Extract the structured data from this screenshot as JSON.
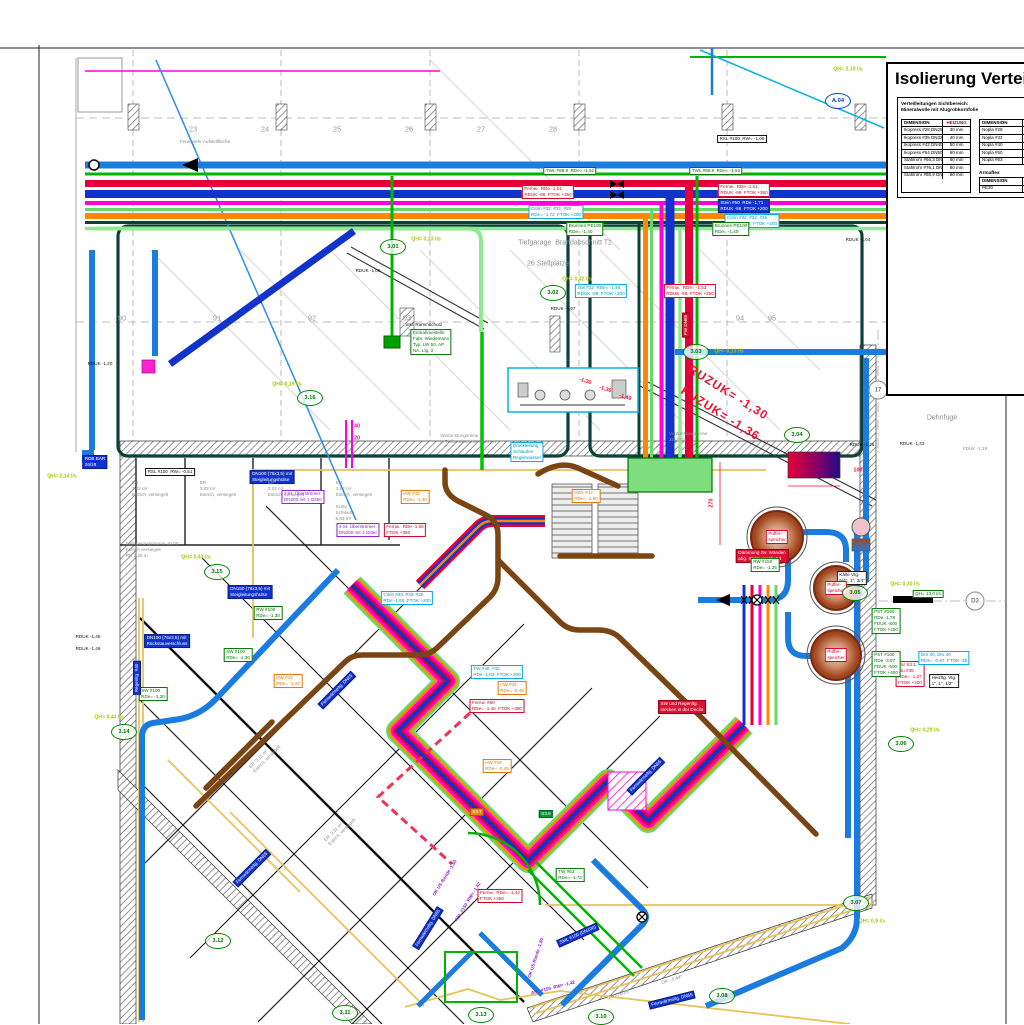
{
  "title_block": {
    "title": "Isolierung Verteilung",
    "note1": "Verteilleitungen Sichtbereich:",
    "note2": "Mineralwolle mit Alugrobkornfolie",
    "armaflex_label": "Armaflex",
    "table1": {
      "headers": [
        "DIMENSION",
        "HEIZUNG"
      ],
      "rows": [
        [
          "Ikopress #28  DN25",
          "30 mm"
        ],
        [
          "Ikopress #35  DN32",
          "40 mm"
        ],
        [
          "Ikopress #42  DN40",
          "50 mm"
        ],
        [
          "Ikopress #54  DN50",
          "60 mm"
        ],
        [
          "Stahlrohr #66,3  DN50",
          "60 mm"
        ],
        [
          "Stahlrohr #76,1  DN65",
          "80 mm"
        ],
        [
          "Stahlrohr #88,9  DN80",
          "90 mm"
        ]
      ]
    },
    "table2": {
      "headers": [
        "DIMENSION",
        ""
      ],
      "rows": [
        [
          "Nopla #28",
          "DN"
        ],
        [
          "Nopla #32",
          "DN"
        ],
        [
          "Nopla #40",
          "DN"
        ],
        [
          "Nopla #50",
          "DN"
        ],
        [
          "Nopla #63",
          "DN"
        ]
      ]
    },
    "table3": {
      "headers": [
        "DIMENSION",
        ""
      ],
      "rows": [
        [
          "PE30",
          "DN"
        ]
      ]
    }
  },
  "palette": {
    "skyblue": "#1b7ce0",
    "navy": "#1133cc",
    "red": "#e60039",
    "green": "#00b400",
    "lightgreen": "#66d966",
    "palegreen": "#90e890",
    "magenta": "#ff00dd",
    "orange": "#ff8800",
    "teal": "#0d4034",
    "brown": "#7a4513",
    "yellow": "#e6c35c",
    "cyan": "#00b4dc",
    "ref_green": "#008800",
    "qh_lime": "#aac800",
    "dim_red": "#ee1133"
  },
  "red_level_note": [
    "RUZUK= -1,30",
    "FUZUK= -1,36"
  ],
  "grid_cols": {
    "y": 129,
    "items": [
      {
        "t": "23",
        "x": 193
      },
      {
        "t": "24",
        "x": 265
      },
      {
        "t": "25",
        "x": 337
      },
      {
        "t": "26",
        "x": 409
      },
      {
        "t": "27",
        "x": 481
      },
      {
        "t": "28",
        "x": 553
      }
    ]
  },
  "grid_rows": {
    "y": 318,
    "items": [
      {
        "t": "90",
        "x": 122
      },
      {
        "t": "91",
        "x": 217
      },
      {
        "t": "92",
        "x": 312
      },
      {
        "t": "93",
        "x": 407
      },
      {
        "t": "94",
        "x": 740
      },
      {
        "t": "95",
        "x": 772
      }
    ]
  },
  "ref_markers": [
    {
      "id": "3.01",
      "x": 393,
      "y": 247
    },
    {
      "id": "3.02",
      "x": 553,
      "y": 293
    },
    {
      "id": "3.03",
      "x": 696,
      "y": 352
    },
    {
      "id": "3.04",
      "x": 797,
      "y": 435
    },
    {
      "id": "3.05",
      "x": 855,
      "y": 593
    },
    {
      "id": "3.06",
      "x": 901,
      "y": 744
    },
    {
      "id": "3.07",
      "x": 856,
      "y": 903
    },
    {
      "id": "3.08",
      "x": 722,
      "y": 996
    },
    {
      "id": "3.10",
      "x": 601,
      "y": 1017
    },
    {
      "id": "3.11",
      "x": 345,
      "y": 1013
    },
    {
      "id": "3.12",
      "x": 218,
      "y": 941
    },
    {
      "id": "3.13",
      "x": 481,
      "y": 1015
    },
    {
      "id": "3.14",
      "x": 124,
      "y": 732
    },
    {
      "id": "3.15",
      "x": 217,
      "y": 572
    },
    {
      "id": "3.16",
      "x": 310,
      "y": 398
    },
    {
      "id": "A.04",
      "x": 838,
      "y": 101,
      "c": "b"
    },
    {
      "id": "A.05",
      "x": 968,
      "y": 333,
      "c": "b"
    },
    {
      "id": "17",
      "x": 878,
      "y": 390,
      "c": "x"
    },
    {
      "id": "D3",
      "x": 975,
      "y": 601,
      "c": "x"
    }
  ],
  "qh_labels": [
    {
      "t": "QH= 2,10 l/s",
      "x": 848,
      "y": 70
    },
    {
      "t": "QH= 0,33 l/s",
      "x": 426,
      "y": 240
    },
    {
      "t": "QH= 0,42 l/s",
      "x": 577,
      "y": 280
    },
    {
      "t": "QH= 0,13 l/s",
      "x": 729,
      "y": 352
    },
    {
      "t": "QH= 1,50 l/s",
      "x": 962,
      "y": 355
    },
    {
      "t": "QH= 2,14 l/s",
      "x": 62,
      "y": 477
    },
    {
      "t": "QH= 0,19 l/s",
      "x": 287,
      "y": 385
    },
    {
      "t": "QH= 0,43 l/s",
      "x": 196,
      "y": 558
    },
    {
      "t": "QH= 0,30 l/s",
      "x": 905,
      "y": 585
    },
    {
      "t": "QH= 0,44 l/s",
      "x": 109,
      "y": 718
    },
    {
      "t": "QH= 0,29 l/s",
      "x": 925,
      "y": 731
    },
    {
      "t": "QH= 0,9 l/s",
      "x": 872,
      "y": 922
    }
  ],
  "labels": [
    {
      "s": "k",
      "x": 742,
      "y": 139,
      "lines": [
        "RSL #100  RW= -1,05"
      ]
    },
    {
      "s": "k",
      "x": 170,
      "y": 472,
      "lines": [
        "RSL #100  RW= -0,51"
      ]
    },
    {
      "s": "g",
      "x": 570,
      "y": 171,
      "lines": [
        "TWL #88,9  RDe= -1,52"
      ]
    },
    {
      "s": "g",
      "x": 716,
      "y": 171,
      "lines": [
        "TWL #88,9  RDe= -1,52"
      ]
    },
    {
      "s": "r",
      "x": 548,
      "y": 192,
      "lines": [
        "Fernw.  RDe -1,51",
        "RDUK -98  FTOK +350"
      ]
    },
    {
      "s": "r",
      "x": 744,
      "y": 190,
      "lines": [
        "Fernw.  RDe -1,51",
        "RDUK -98  FTOK +350"
      ]
    },
    {
      "s": "bf",
      "x": 744,
      "y": 206,
      "lines": [
        "Stein #50  RDe -1,71",
        "RDUK -98  FTOK +200"
      ]
    },
    {
      "s": "c",
      "x": 556,
      "y": 212,
      "lines": [
        "Citrin #32, #32, #25",
        "RDe= -1,72  FTOK +200"
      ]
    },
    {
      "s": "c",
      "x": 752,
      "y": 221,
      "lines": [
        "Citrin #32, #32, #25",
        "RDe= -1,72  FTOK +200"
      ]
    },
    {
      "s": "g",
      "x": 585,
      "y": 229,
      "lines": [
        "Brunnen PE100",
        "RDe= -1,40"
      ]
    },
    {
      "s": "g",
      "x": 731,
      "y": 229,
      "lines": [
        "Brunnen PE100",
        "RDe= -1,40"
      ]
    },
    {
      "s": "c",
      "x": 601,
      "y": 291,
      "lines": [
        "Stw #32  RDe= -1,46",
        "RDUK -98  FTOK +200"
      ]
    },
    {
      "s": "r",
      "x": 690,
      "y": 291,
      "lines": [
        "Fernw.  RDe= -1,53",
        "RDUK -98  FTOK +350"
      ]
    },
    {
      "s": "g",
      "x": 431,
      "y": 342,
      "lines": [
        "Entnahmestelle",
        "Fabr. Wiedemann",
        "Typ. LW 50, AP",
        "NA. Ltg. 2"
      ]
    },
    {
      "s": "kt",
      "x": 424,
      "y": 325,
      "lines": [
        "inkl. Rammschutz"
      ]
    },
    {
      "s": "bf",
      "x": 272,
      "y": 477,
      "lines": [
        "DN100 (76x3,5) mit",
        "Steigleitungshülse"
      ]
    },
    {
      "s": "v",
      "x": 303,
      "y": 497,
      "lines": [
        "2 St. Überströmer",
        "DN200 mit 1 Gitter"
      ]
    },
    {
      "s": "v",
      "x": 358,
      "y": 530,
      "lines": [
        "2 St. Überströmer",
        "DN200 mit 1 Gitter"
      ]
    },
    {
      "s": "bf",
      "x": 250,
      "y": 592,
      "lines": [
        "DN150 (76x3,5) mit",
        "Steigleitungshülse"
      ]
    },
    {
      "s": "bf",
      "x": 167,
      "y": 641,
      "lines": [
        "DN100 (76x3,5) mit",
        "Rückstauverschluss"
      ]
    },
    {
      "s": "g",
      "x": 268,
      "y": 613,
      "lines": [
        "RW #100",
        "RDe= -1,30"
      ]
    },
    {
      "s": "g",
      "x": 238,
      "y": 655,
      "lines": [
        "SW #100",
        "RDe= -1,36"
      ]
    },
    {
      "s": "g",
      "x": 153,
      "y": 694,
      "lines": [
        "SW #100",
        "RDe= -1,30"
      ]
    },
    {
      "s": "o",
      "x": 415,
      "y": 497,
      "lines": [
        "HW #42",
        "RDe= -1,48"
      ]
    },
    {
      "s": "o",
      "x": 288,
      "y": 681,
      "lines": [
        "HW #42",
        "RDe= -1,47"
      ]
    },
    {
      "s": "o",
      "x": 512,
      "y": 688,
      "lines": [
        "HW #42",
        "RDe= -0,48"
      ]
    },
    {
      "s": "o",
      "x": 497,
      "y": 766,
      "lines": [
        "HW #42",
        "RDe= -0,45"
      ]
    },
    {
      "s": "o",
      "x": 586,
      "y": 496,
      "lines": [
        "HZG #42",
        "RDe= -1,60"
      ]
    },
    {
      "s": "c",
      "x": 407,
      "y": 598,
      "lines": [
        "Citrin #40, #32, #25",
        "RDe -1,65  FTOK +200"
      ]
    },
    {
      "s": "c",
      "x": 497,
      "y": 672,
      "lines": [
        "TW #40, #32",
        "RDe -1,63  FTOK +200"
      ]
    },
    {
      "s": "r",
      "x": 405,
      "y": 530,
      "lines": [
        "Fernw.  RDe -1,55",
        "FTOK +350"
      ]
    },
    {
      "s": "r",
      "x": 497,
      "y": 706,
      "lines": [
        "Fernw. #60",
        "RDe= -1,46  FTOK +350"
      ]
    },
    {
      "s": "r",
      "x": 500,
      "y": 896,
      "lines": [
        "Fernw.  RDe= -1,42",
        "FTOK +350"
      ]
    },
    {
      "s": "rf",
      "x": 682,
      "y": 707,
      "lines": [
        "SW und Regenltg.",
        "stecken in der Decke"
      ]
    },
    {
      "s": "rf",
      "x": 762,
      "y": 556,
      "lines": [
        "Dämmung zw. Wänden",
        "abg. Strömungsband"
      ]
    },
    {
      "s": "r",
      "x": 910,
      "y": 674,
      "lines": [
        "Tür S3.1",
        "Alu #35",
        "RDe= -1,07",
        "FTOK +200"
      ]
    },
    {
      "s": "c",
      "x": 944,
      "y": 658,
      "lines": [
        "Dre 40, Drv 40",
        "RDe= -0,97  FTOK -35"
      ]
    },
    {
      "s": "k",
      "x": 944,
      "y": 681,
      "lines": [
        "Heizltg. Vtg.",
        "1\", 1\", 1/2\""
      ]
    },
    {
      "s": "g",
      "x": 886,
      "y": 621,
      "lines": [
        "PST #160",
        "RDe -1,78",
        "FDUK -500",
        "FTOK +400"
      ]
    },
    {
      "s": "g",
      "x": 886,
      "y": 664,
      "lines": [
        "PST #160",
        "RDe -3,07",
        "FDUK -500",
        "FTOK +400"
      ]
    },
    {
      "s": "g",
      "x": 765,
      "y": 565,
      "lines": [
        "RW #150",
        "RDe= -1,25"
      ]
    },
    {
      "s": "k",
      "x": 852,
      "y": 578,
      "lines": [
        "Kälte Vtg.",
        "5/4\", 1\", 3/4\""
      ]
    },
    {
      "s": "c",
      "x": 527,
      "y": 452,
      "lines": [
        "Druckleitung",
        "Schlaufen",
        "Regenwasser"
      ]
    },
    {
      "s": "g",
      "x": 570,
      "y": 875,
      "lines": [
        "TW #63",
        "RDe= -1,73"
      ]
    },
    {
      "s": "bf",
      "x": 95,
      "y": 462,
      "lines": [
        "RDB BAR",
        "26/28"
      ]
    },
    {
      "s": "gf",
      "x": 546,
      "y": 814,
      "lines": [
        "S3.8"
      ]
    },
    {
      "s": "of",
      "x": 477,
      "y": 812,
      "lines": [
        "S3.7"
      ]
    },
    {
      "s": "g",
      "x": 928,
      "y": 594,
      "lines": [
        "QH= 13,0 l/s"
      ]
    },
    {
      "s": "bf",
      "x": 337,
      "y": 690,
      "rot": -45,
      "lines": [
        "Fernwärmeltg. DN65"
      ]
    },
    {
      "s": "bf",
      "x": 252,
      "y": 868,
      "rot": -45,
      "lines": [
        "Fernwärmeltg. DN65"
      ]
    },
    {
      "s": "bf",
      "x": 428,
      "y": 928,
      "rot": -58,
      "lines": [
        "Fernwärmeltg. DN65"
      ]
    },
    {
      "s": "bf",
      "x": 646,
      "y": 776,
      "rot": -45,
      "lines": [
        "Fernwärmeltg. DN65"
      ]
    },
    {
      "s": "bf",
      "x": 578,
      "y": 935,
      "rot": -24,
      "lines": [
        "SML #100 (DN100)"
      ]
    },
    {
      "s": "bf",
      "x": 672,
      "y": 1000,
      "rot": -14,
      "lines": [
        "Fernwärmeltg. DN65"
      ]
    },
    {
      "s": "bf",
      "x": 137,
      "y": 678,
      "rot": -90,
      "lines": [
        "Regenltg. #40"
      ]
    },
    {
      "s": "kt",
      "x": 958,
      "y": 341,
      "lines": [
        "328 RV  26/28"
      ]
    },
    {
      "s": "rf",
      "x": 686,
      "y": 325,
      "rot": -90,
      "lines": [
        "FW DN65"
      ]
    },
    {
      "s": "vt",
      "x": 468,
      "y": 902,
      "rot": -58,
      "lines": [
        "ASL #150  RW= -1,42"
      ]
    },
    {
      "s": "vt",
      "x": 445,
      "y": 878,
      "rot": -58,
      "lines": [
        "OK US Rande -1,50"
      ]
    },
    {
      "s": "vt",
      "x": 536,
      "y": 958,
      "rot": -72,
      "lines": [
        "OK US Rande -1,50"
      ]
    },
    {
      "s": "vt",
      "x": 553,
      "y": 988,
      "rot": -14,
      "lines": [
        "ASL #150  RW= -1,42"
      ]
    },
    {
      "s": "r",
      "x": 777,
      "y": 537,
      "lines": [
        "Puffer-",
        "speicher"
      ]
    },
    {
      "s": "r",
      "x": 836,
      "y": 588,
      "lines": [
        "Puffer-",
        "speicher"
      ]
    },
    {
      "s": "r",
      "x": 836,
      "y": 655,
      "lines": [
        "Puffer-",
        "speicher"
      ]
    },
    {
      "s": "kt",
      "x": 858,
      "y": 240,
      "lines": [
        "RDUK -1,04"
      ]
    },
    {
      "s": "kt",
      "x": 100,
      "y": 364,
      "lines": [
        "RDUK -1,20"
      ]
    },
    {
      "s": "kt",
      "x": 862,
      "y": 445,
      "lines": [
        "RDUK -1,26"
      ]
    },
    {
      "s": "kt",
      "x": 912,
      "y": 444,
      "lines": [
        "RDUK -1,43"
      ]
    },
    {
      "s": "gt",
      "x": 975,
      "y": 449,
      "lines": [
        "FDUK -1,29"
      ]
    },
    {
      "s": "kt",
      "x": 368,
      "y": 271,
      "lines": [
        "RDUK -1,06"
      ]
    },
    {
      "s": "kt",
      "x": 563,
      "y": 309,
      "lines": [
        "RDUK -0,97"
      ]
    },
    {
      "s": "kt",
      "x": 88,
      "y": 637,
      "lines": [
        "RDUK -1,45"
      ]
    },
    {
      "s": "kt",
      "x": 88,
      "y": 649,
      "lines": [
        "RDUK -1,49"
      ]
    },
    {
      "s": "gt",
      "x": 942,
      "y": 418,
      "fs": 7,
      "lines": [
        "Dehnfuge"
      ]
    },
    {
      "s": "gt",
      "x": 565,
      "y": 243,
      "fs": 7,
      "lines": [
        "Tiefgarage  Brandabschnitt T1"
      ]
    },
    {
      "s": "gt",
      "x": 548,
      "y": 264,
      "fs": 7,
      "lines": [
        "26 Stellplätze"
      ]
    },
    {
      "s": "gt",
      "x": 205,
      "y": 142,
      "lines": [
        "Feuerwehr Aufstellfläche"
      ]
    },
    {
      "s": "gt",
      "x": 152,
      "y": 550,
      "lines": [
        "Einlagerungsräume ±0,00",
        "Estrich versiegelt",
        "RH 2,26 m"
      ]
    },
    {
      "s": "gt",
      "x": 468,
      "y": 439,
      "lines": [
        "Verdunstungsrinne",
        "in Tiefbereich unterbrochen"
      ]
    },
    {
      "s": "gt",
      "x": 688,
      "y": 437,
      "lines": [
        "Verdunstungsrinne",
        "35x3 cm"
      ]
    },
    {
      "s": "gt",
      "x": 150,
      "y": 489,
      "lines": [
        "ER",
        "3,02 m²",
        "Estrich, versiegelt"
      ]
    },
    {
      "s": "gt",
      "x": 218,
      "y": 489,
      "lines": [
        "ER",
        "3,02 m²",
        "Estrich, versiegelt"
      ]
    },
    {
      "s": "gt",
      "x": 286,
      "y": 489,
      "lines": [
        "ER",
        "3,02 m²",
        "Estrich, versiegelt"
      ]
    },
    {
      "s": "gt",
      "x": 354,
      "y": 489,
      "lines": [
        "ER",
        "3,02 m²",
        "Estrich, versiegelt"
      ]
    },
    {
      "s": "gt",
      "x": 345,
      "y": 513,
      "lines": [
        "SU02",
        "Schleuse",
        "6,83 m²"
      ]
    },
    {
      "s": "gt",
      "x": 265,
      "y": 757,
      "rot": -45,
      "lines": [
        "ER  3,11 m²",
        "Estrich, versiegelt"
      ]
    },
    {
      "s": "gt",
      "x": 340,
      "y": 830,
      "rot": -45,
      "lines": [
        "ER  3,11 m²",
        "Estrich, versiegelt"
      ]
    },
    {
      "s": "gt",
      "x": 618,
      "y": 995,
      "rot": -17,
      "lines": [
        "UT-VTB 05"
      ]
    },
    {
      "s": "gt",
      "x": 672,
      "y": 980,
      "rot": -17,
      "lines": [
        "OK  -5,44°"
      ]
    },
    {
      "s": "gt",
      "x": 988,
      "y": 264,
      "lines": [
        "sind t/s"
      ]
    },
    {
      "s": "kt",
      "x": 930,
      "y": 272,
      "b": 1,
      "lines": [
        "RDUK UG"
      ]
    },
    {
      "s": "kt",
      "x": 963,
      "y": 287,
      "b": 1,
      "lines": [
        "FDUK UG"
      ]
    },
    {
      "s": "rt2",
      "x": 712,
      "y": 503,
      "rot": -90,
      "lines": [
        "270"
      ]
    },
    {
      "s": "rt2",
      "x": 858,
      "y": 471,
      "lines": [
        "100"
      ]
    },
    {
      "s": "mag",
      "x": 357,
      "y": 427,
      "lines": [
        "40"
      ]
    },
    {
      "s": "mag",
      "x": 357,
      "y": 439,
      "lines": [
        "20"
      ]
    },
    {
      "s": "rt2",
      "x": 585,
      "y": 382,
      "rot": 18,
      "lines": [
        "-1,30"
      ]
    },
    {
      "s": "rt2",
      "x": 605,
      "y": 390,
      "rot": 18,
      "lines": [
        "-1,36"
      ]
    },
    {
      "s": "rt2",
      "x": 625,
      "y": 398,
      "rot": 18,
      "lines": [
        "-1,49"
      ]
    },
    {
      "s": "rt",
      "x": 728,
      "y": 393,
      "rot": 32,
      "lines": [
        "RUZUK= -1,30"
      ]
    },
    {
      "s": "rt",
      "x": 720,
      "y": 414,
      "rot": 32,
      "lines": [
        "FUZUK= -1,36"
      ]
    }
  ]
}
